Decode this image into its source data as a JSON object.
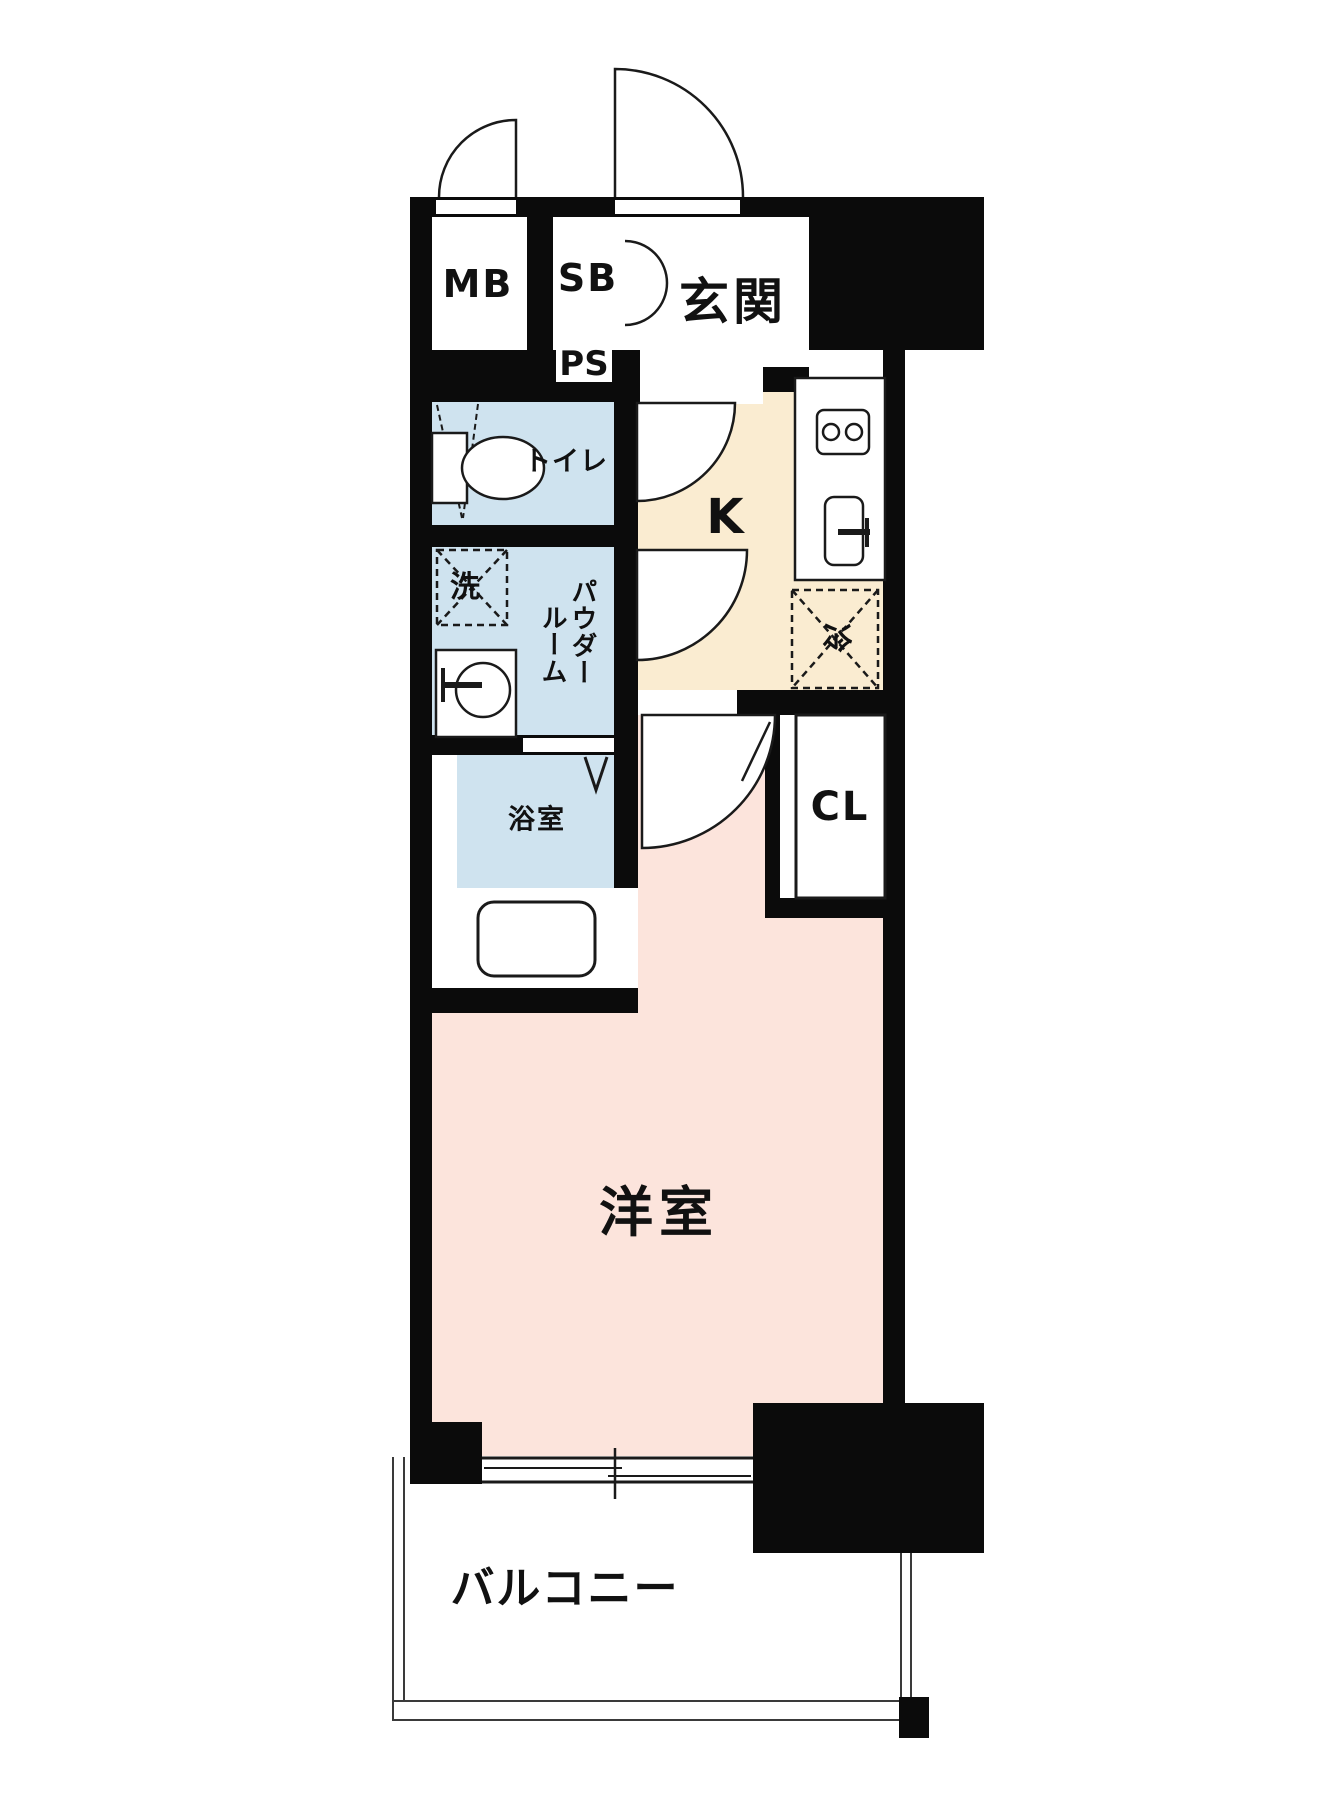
{
  "plan_title": "1K apartment floor plan",
  "colors": {
    "wall": "#0b0b0b",
    "outline": "#1a1a1a",
    "water_rooms": "#cfe3ef",
    "kitchen_floor": "#faecd1",
    "main_room_floor": "#fce4dc"
  },
  "rooms": {
    "meter_box": "MB",
    "shoe_box": "SB",
    "entrance": "玄関",
    "pipe_space": "PS",
    "toilet": "トイレ",
    "kitchen": "K",
    "washer": "洗",
    "powder_room_line1": "パウダー",
    "powder_room_line2": "ルーム",
    "fridge": "冷",
    "bathroom": "浴室",
    "closet": "CL",
    "western_room": "洋室",
    "balcony": "バルコニー"
  }
}
